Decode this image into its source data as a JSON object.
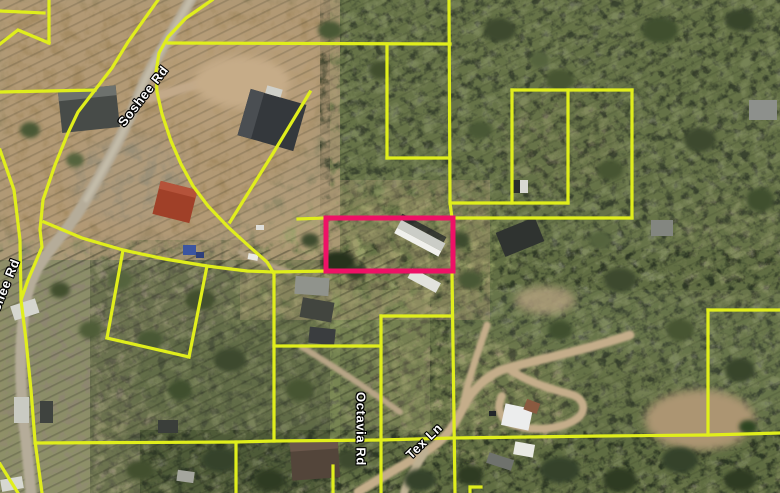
{
  "map": {
    "road_labels": [
      {
        "id": "soshee-main",
        "text": "Soshee Rd",
        "x": 143,
        "y": 96,
        "rotate": -52
      },
      {
        "id": "soshee-left",
        "text": "Soshee Rd",
        "x": 2,
        "y": 293,
        "rotate": -68
      },
      {
        "id": "octavia",
        "text": "Octavia Rd",
        "x": 361,
        "y": 429,
        "rotate": 90
      },
      {
        "id": "tex-ln",
        "text": "Tex Ln",
        "x": 424,
        "y": 441,
        "rotate": -44
      }
    ],
    "parcel_line_color": "#e0ee1c",
    "parcel_line_width": 3.2,
    "highlight_parcel": {
      "x": 326,
      "y": 218,
      "width": 127,
      "height": 53,
      "color": "#ee1166",
      "stroke_width": 5
    },
    "parcel_lines": [
      {
        "points": [
          [
            0,
            11
          ],
          [
            44,
            13
          ]
        ]
      },
      {
        "points": [
          [
            0,
            44
          ],
          [
            18,
            30
          ],
          [
            49,
            43
          ]
        ]
      },
      {
        "points": [
          [
            49,
            0
          ],
          [
            49,
            43
          ]
        ]
      },
      {
        "points": [
          [
            212,
            0
          ],
          [
            186,
            18
          ],
          [
            168,
            37
          ],
          [
            159,
            53
          ],
          [
            156,
            72
          ],
          [
            157,
            92
          ],
          [
            162,
            114
          ],
          [
            171,
            141
          ],
          [
            181,
            164
          ],
          [
            193,
            186
          ],
          [
            208,
            206
          ],
          [
            228,
            227
          ],
          [
            251,
            248
          ],
          [
            267,
            262
          ],
          [
            273,
            272
          ]
        ]
      },
      {
        "points": [
          [
            168,
            43
          ],
          [
            450,
            44
          ]
        ]
      },
      {
        "points": [
          [
            387,
            44
          ],
          [
            387,
            158
          ]
        ]
      },
      {
        "points": [
          [
            387,
            158
          ],
          [
            450,
            158
          ]
        ]
      },
      {
        "points": [
          [
            449,
            0
          ],
          [
            450,
            203
          ],
          [
            452,
            218
          ]
        ]
      },
      {
        "points": [
          [
            450,
            203
          ],
          [
            568,
            203
          ]
        ]
      },
      {
        "points": [
          [
            512,
            90
          ],
          [
            512,
            203
          ]
        ]
      },
      {
        "points": [
          [
            512,
            90
          ],
          [
            632,
            90
          ]
        ]
      },
      {
        "points": [
          [
            632,
            90
          ],
          [
            632,
            218
          ]
        ]
      },
      {
        "points": [
          [
            568,
            90
          ],
          [
            568,
            203
          ]
        ]
      },
      {
        "points": [
          [
            452,
            218
          ],
          [
            632,
            218
          ]
        ]
      },
      {
        "points": [
          [
            298,
            219
          ],
          [
            326,
            218
          ]
        ]
      },
      {
        "points": [
          [
            230,
            222
          ],
          [
            272,
            155
          ],
          [
            310,
            92
          ]
        ]
      },
      {
        "points": [
          [
            158,
            0
          ],
          [
            128,
            42
          ],
          [
            112,
            68
          ],
          [
            95,
            90
          ]
        ]
      },
      {
        "points": [
          [
            0,
            92
          ],
          [
            95,
            90
          ]
        ]
      },
      {
        "points": [
          [
            95,
            90
          ],
          [
            78,
            112
          ],
          [
            68,
            133
          ],
          [
            55,
            165
          ],
          [
            43,
            200
          ],
          [
            40,
            230
          ],
          [
            42,
            247
          ],
          [
            28,
            280
          ],
          [
            21,
            300
          ],
          [
            26,
            340
          ],
          [
            31,
            390
          ],
          [
            35,
            441
          ],
          [
            42,
            493
          ]
        ]
      },
      {
        "points": [
          [
            0,
            150
          ],
          [
            14,
            190
          ],
          [
            20,
            240
          ],
          [
            21,
            298
          ]
        ]
      },
      {
        "points": [
          [
            44,
            222
          ],
          [
            82,
            238
          ],
          [
            123,
            250
          ],
          [
            165,
            259
          ],
          [
            207,
            266
          ],
          [
            247,
            271
          ],
          [
            273,
            272
          ]
        ]
      },
      {
        "points": [
          [
            207,
            266
          ],
          [
            189,
            357
          ]
        ]
      },
      {
        "points": [
          [
            189,
            357
          ],
          [
            107,
            338
          ]
        ]
      },
      {
        "points": [
          [
            107,
            338
          ],
          [
            123,
            250
          ]
        ]
      },
      {
        "points": [
          [
            273,
            272
          ],
          [
            326,
            271
          ]
        ]
      },
      {
        "points": [
          [
            274,
            272
          ],
          [
            274,
            441
          ]
        ]
      },
      {
        "points": [
          [
            274,
            346
          ],
          [
            381,
            346
          ]
        ]
      },
      {
        "points": [
          [
            381,
            316
          ],
          [
            381,
            493
          ]
        ]
      },
      {
        "points": [
          [
            381,
            316
          ],
          [
            452,
            316
          ]
        ]
      },
      {
        "points": [
          [
            452,
            272
          ],
          [
            455,
            493
          ]
        ]
      },
      {
        "points": [
          [
            35,
            443
          ],
          [
            236,
            442
          ],
          [
            274,
            441
          ],
          [
            381,
            440
          ],
          [
            453,
            438
          ],
          [
            600,
            436
          ],
          [
            708,
            435
          ],
          [
            780,
            433
          ]
        ]
      },
      {
        "points": [
          [
            236,
            442
          ],
          [
            236,
            493
          ]
        ]
      },
      {
        "points": [
          [
            333,
            466
          ],
          [
            333,
            493
          ]
        ]
      },
      {
        "points": [
          [
            708,
            310
          ],
          [
            780,
            310
          ]
        ]
      },
      {
        "points": [
          [
            708,
            310
          ],
          [
            708,
            435
          ]
        ]
      },
      {
        "points": [
          [
            0,
            464
          ],
          [
            18,
            493
          ]
        ]
      },
      {
        "points": [
          [
            470,
            493
          ],
          [
            470,
            487
          ],
          [
            481,
            487
          ]
        ]
      }
    ]
  }
}
